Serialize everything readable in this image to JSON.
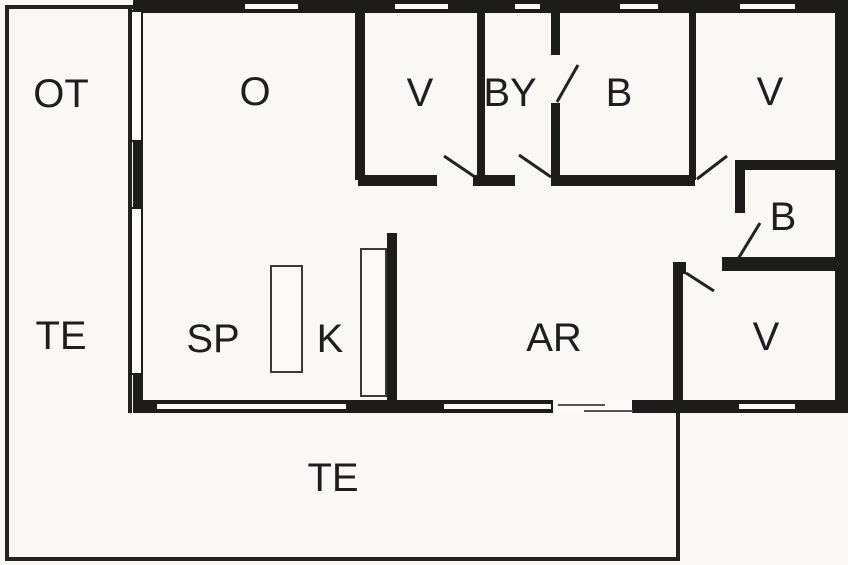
{
  "plan": {
    "type": "floor-plan",
    "description": "summerhouse floor plan with terraces"
  },
  "colors": {
    "wall": "#1c1c1a",
    "terrace_line": "#222220",
    "background": "#f9f8f4",
    "label_text": "#1e1e1e",
    "window_fill": "#fbfaf6"
  },
  "rooms": [
    {
      "id": "ot",
      "label": "OT"
    },
    {
      "id": "o",
      "label": "O"
    },
    {
      "id": "v1",
      "label": "V"
    },
    {
      "id": "by",
      "label": "BY"
    },
    {
      "id": "b1",
      "label": "B"
    },
    {
      "id": "v2",
      "label": "V"
    },
    {
      "id": "b2",
      "label": "B"
    },
    {
      "id": "te-left",
      "label": "TE"
    },
    {
      "id": "sp",
      "label": "SP"
    },
    {
      "id": "k",
      "label": "K"
    },
    {
      "id": "ar",
      "label": "AR"
    },
    {
      "id": "v3",
      "label": "V"
    },
    {
      "id": "te-bottom",
      "label": "TE"
    }
  ]
}
